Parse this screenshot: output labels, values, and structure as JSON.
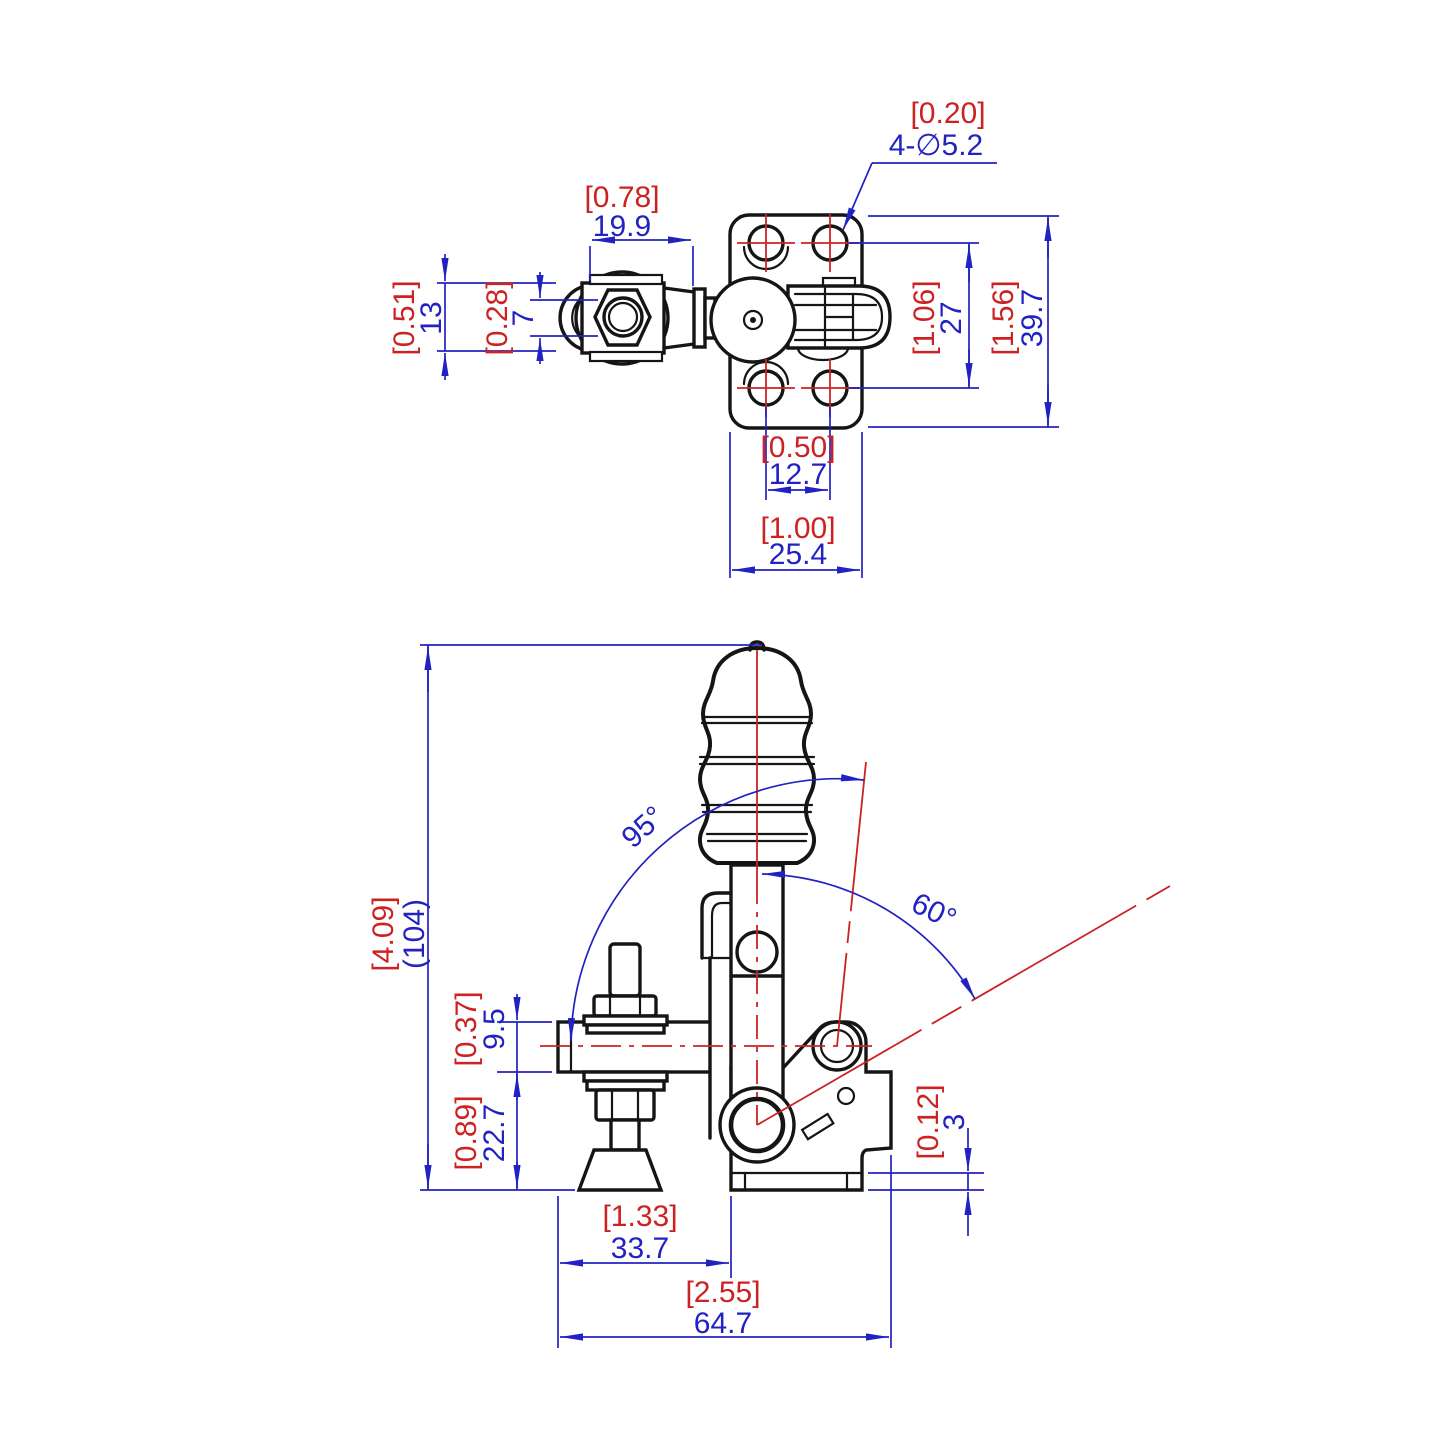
{
  "colors": {
    "dimension_blue": "#2222c2",
    "annotation_red": "#cc2222",
    "outline_ink": "#151515",
    "background": "#ffffff"
  },
  "top": {
    "callout": {
      "inch": "[0.20]",
      "label": "4-∅5.2"
    },
    "spindle_width": {
      "inch": "[0.78]",
      "mm": "19.9"
    },
    "pad_height": {
      "inch": "[0.51]",
      "mm": "13"
    },
    "shaft_height": {
      "inch": "[0.28]",
      "mm": "7"
    },
    "hole_spacing_v": {
      "inch": "[1.06]",
      "mm": "27"
    },
    "plate_height": {
      "inch": "[1.56]",
      "mm": "39.7"
    },
    "hole_spacing_h": {
      "inch": "[0.50]",
      "mm": "12.7"
    },
    "plate_width": {
      "inch": "[1.00]",
      "mm": "25.4"
    }
  },
  "front": {
    "open_angle": "95°",
    "handle_angle": "60°",
    "overall_height": {
      "inch": "[4.09]",
      "mm": "(104)"
    },
    "bar_thickness": {
      "inch": "[0.37]",
      "mm": "9.5"
    },
    "bar_to_base": {
      "inch": "[0.89]",
      "mm": "22.7"
    },
    "flange_thickness": {
      "inch": "[0.12]",
      "mm": "3"
    },
    "arm_reach": {
      "inch": "[1.33]",
      "mm": "33.7"
    },
    "overall_length": {
      "inch": "[2.55]",
      "mm": "64.7"
    }
  }
}
